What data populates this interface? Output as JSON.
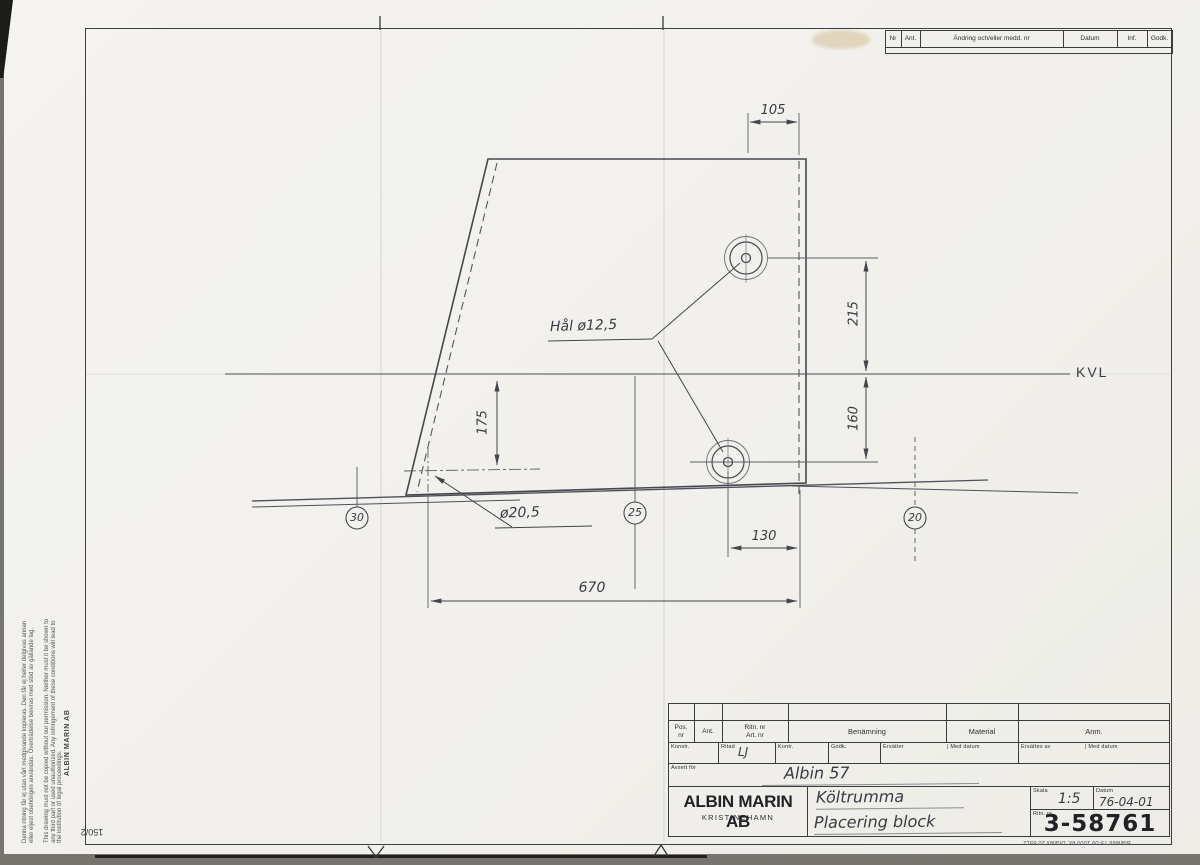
{
  "sheet": {
    "sheet_number": "150/2",
    "form_footer": "Blankett 75-09 1000 ex. Draflex 20 6512",
    "legal_notice_sv": "Denna ritning får ej utan vårt medgivande kopieras. Den får ej heller delgivas annan eller eljest obehörigen användas. Överträdelse beivras med stöd av gällande lag.",
    "legal_notice_en": "This drawing must not be copied without our permission. Neither must it be shown to any third part or used unauthorized. Any infringement of these conditions will lead to the institution of legal proceedings.",
    "company_margin": "ALBIN MARIN AB"
  },
  "revision_table": {
    "headers": [
      "Nr",
      "Ant.",
      "Ändring och/eller medd. nr",
      "Datum",
      "Inf.",
      "Godk."
    ]
  },
  "drawing": {
    "kvl": "KVL",
    "hole_note": "Hål ø12,5",
    "dia_note": "ø20,5",
    "dim_top": "105",
    "dim_upper_right": "215",
    "dim_lower_right": "160",
    "dim_left_vertical": "175",
    "dim_hole_to_edge": "130",
    "dim_overall": "670",
    "station_1": "30",
    "station_2": "25",
    "station_3": "20"
  },
  "title_block": {
    "header": {
      "pos_1": "Pos.",
      "pos_2": "nr",
      "ant": "Ant.",
      "ritn_1": "Ritn. nr",
      "ritn_2": "Art. nr",
      "benamning": "Benämning",
      "material": "Material",
      "anm": "Anm."
    },
    "signature_row": {
      "konstr": "Konstr.",
      "ritad": "Ritad",
      "ritad_value": "LJ",
      "kontr": "Kontr.",
      "godk": "Godk.",
      "ersatter": "Ersätter",
      "med_datum_1": "| Med datum",
      "ersattes_av": "Ersättes av",
      "med_datum_2": "| Med datum"
    },
    "avsett_for_label": "Avsett för",
    "avsett_for_value": "Albin 57",
    "company_name": "ALBIN MARIN AB",
    "company_city": "KRISTINEHAMN",
    "benamning_line1": "Költrumma",
    "benamning_line2": "Placering block",
    "skala_label": "Skala",
    "skala_value": "1:5",
    "datum_label": "Datum",
    "datum_value": "76-04-01",
    "ritn_nr_label": "Ritn. nr",
    "ritn_nr_value": "3-58761"
  },
  "colors": {
    "paper": "#f2f1ed",
    "line": "#4c4c52",
    "ink": "#3a3a42"
  }
}
